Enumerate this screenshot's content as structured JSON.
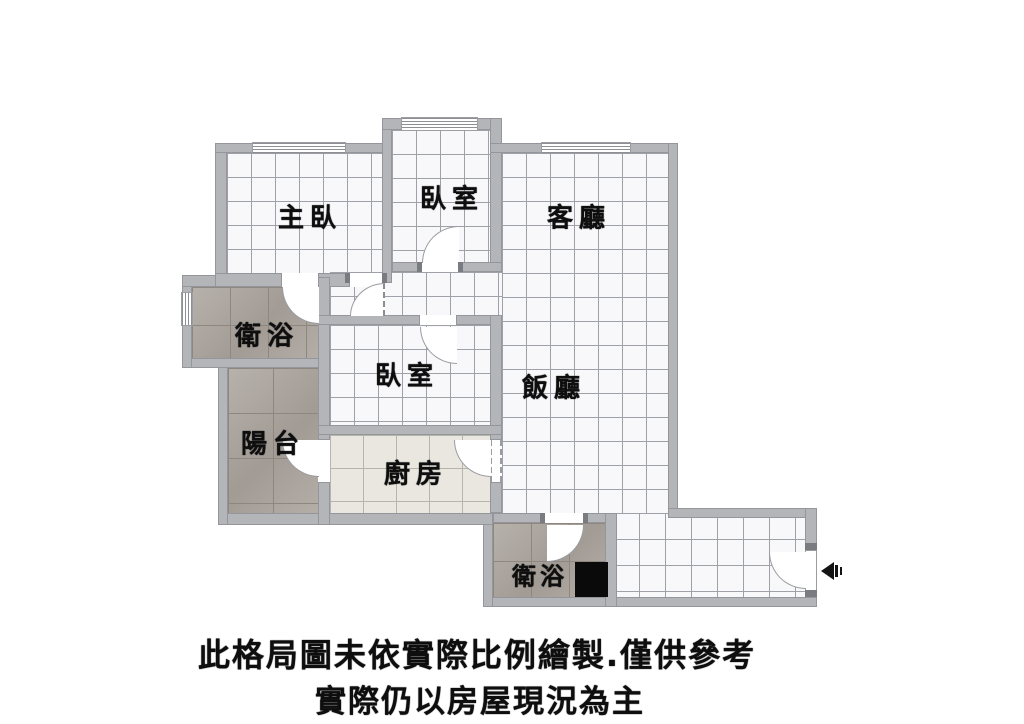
{
  "plan": {
    "type": "apartment-floor-plan",
    "rooms": [
      {
        "id": "master-bedroom",
        "label": "主臥"
      },
      {
        "id": "bedroom-top",
        "label": "臥室"
      },
      {
        "id": "living-room",
        "label": "客廳"
      },
      {
        "id": "bathroom-main",
        "label": "衛浴"
      },
      {
        "id": "bedroom-middle",
        "label": "臥室"
      },
      {
        "id": "dining-room",
        "label": "飯廳"
      },
      {
        "id": "balcony",
        "label": "陽台"
      },
      {
        "id": "kitchen",
        "label": "廚房"
      },
      {
        "id": "bathroom-guest",
        "label": "衛浴"
      }
    ],
    "entrance": {
      "arrow_direction": "left"
    },
    "colors": {
      "wall": "#b3b5b9",
      "tile_floor": "#f8f8fa",
      "tile_grid_line": "#9fa1a8",
      "wet_area_floor": "#aca59e",
      "kitchen_floor": "#eae7e0",
      "fixture_black": "#0a0a0a",
      "annotation_text": "#0e0e0e"
    }
  },
  "disclaimer": {
    "line1": "此格局圖未依實際比例繪製.僅供參考",
    "line2": "實際仍以房屋現況為主"
  }
}
